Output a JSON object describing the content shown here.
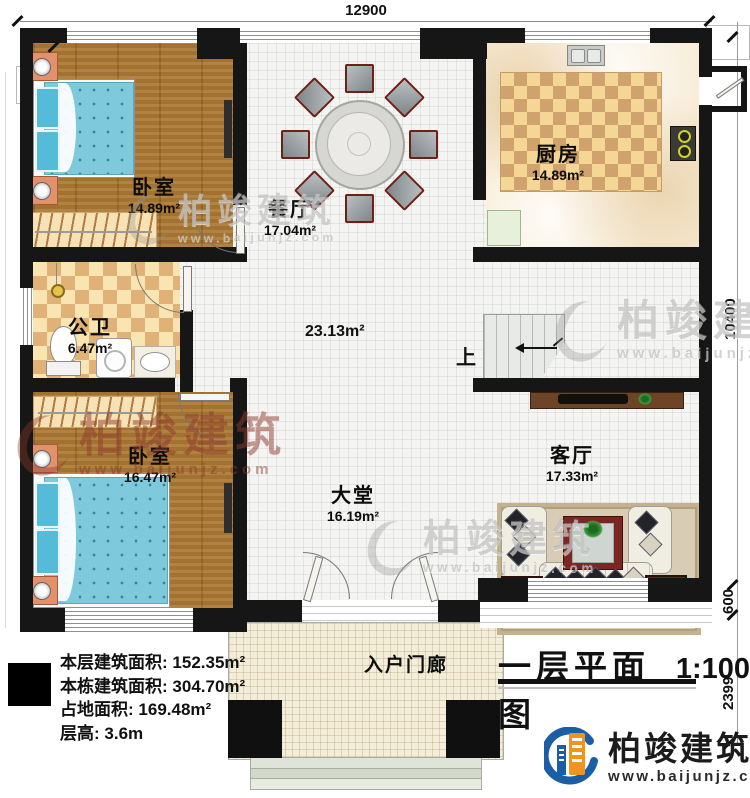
{
  "title_block": {
    "title": "一层平面图",
    "scale": "1:100"
  },
  "dimensions": {
    "top_width": "12900",
    "right_height": "10400",
    "right_mid": "600",
    "right_bottom": "2399"
  },
  "rooms": {
    "bedroom1": {
      "name": "卧室",
      "area": "14.89m²"
    },
    "dining": {
      "name": "餐厅",
      "area": "17.04m²"
    },
    "kitchen": {
      "name": "厨房",
      "area": "14.89m²"
    },
    "bathroom": {
      "name": "公卫",
      "area": "6.47m²"
    },
    "bedroom2": {
      "name": "卧室",
      "area": "16.47m²"
    },
    "hall": {
      "area": "23.13m²"
    },
    "lobby": {
      "name": "大堂",
      "area": "16.19m²"
    },
    "living": {
      "name": "客厅",
      "area": "17.33m²"
    },
    "porch": {
      "name": "入户门廊"
    }
  },
  "stairs": {
    "direction_label": "上"
  },
  "stats": {
    "rows": [
      {
        "label": "本层建筑面积:",
        "value": "152.35m²"
      },
      {
        "label": "本栋建筑面积:",
        "value": "304.70m²"
      },
      {
        "label": "占地面积:",
        "value": "169.48m²"
      },
      {
        "label": "层高:",
        "value": "3.6m"
      }
    ]
  },
  "branding": {
    "company": "柏竣建筑",
    "website": "www.baijunjz.com"
  },
  "watermark": {
    "company": "柏竣建筑",
    "website": "www.baijunjz.com"
  },
  "colors": {
    "wall": "#161616",
    "wood_floor": "#ab7833",
    "tile_floor": "#f4f4f2",
    "marble_floor": "#f7ecd6",
    "checker_dark": "#d0a26e",
    "checker_light": "#f4d795",
    "bed_blue": "#7ec9dc",
    "logo_blue": "#1b5ea6",
    "logo_orange": "#f0941d",
    "watermark_gray": "#949494",
    "watermark_red": "#8d3a2d"
  }
}
